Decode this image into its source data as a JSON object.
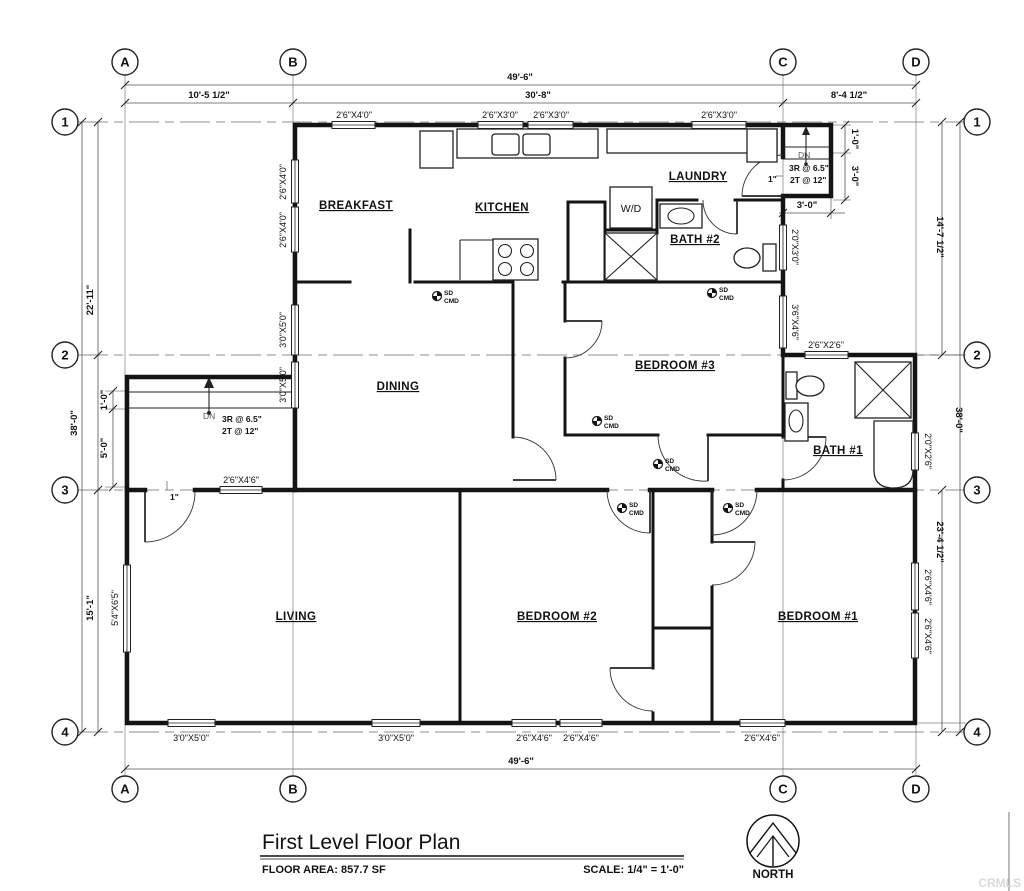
{
  "grid": {
    "cols": [
      "A",
      "B",
      "C",
      "D"
    ],
    "rows": [
      "1",
      "2",
      "3",
      "4"
    ]
  },
  "dims": {
    "overall_w": "49'-6\"",
    "ab": "10'-5 1/2\"",
    "bc": "30'-8\"",
    "cd": "8'-4 1/2\"",
    "left_12": "22'-11\"",
    "overall_h": "38'-0\"",
    "left_34": "15'-1\"",
    "right_12": "14'-7 1/2\"",
    "right_34": "23'-4 1/2\"",
    "one_ft": "1'-0\"",
    "five_ft": "5'-0\"",
    "three_ft": "3'-0\"",
    "one_in": "1\""
  },
  "rooms": {
    "breakfast": "BREAKFAST",
    "kitchen": "KITCHEN",
    "laundry": "LAUNDRY",
    "bath2": "BATH #2",
    "dining": "DINING",
    "bedroom3": "BEDROOM #3",
    "bath1": "BATH #1",
    "living": "LIVING",
    "bedroom2": "BEDROOM #2",
    "bedroom1": "BEDROOM #1",
    "wd": "W/D"
  },
  "windows": {
    "s2640": "2'6\"X4'0\"",
    "s2630": "2'6\"X3'0\"",
    "s3050": "3'0\"X5'0\"",
    "s2646": "2'6\"X4'6\"",
    "s2030": "2'0\"X3'0\"",
    "s3646": "3'6\"X4'6\"",
    "s2626": "2'6\"X2'6\"",
    "s2026": "2'0\"X2'6\"",
    "s5465": "5'4\"X6'5\""
  },
  "stairs": {
    "down_label": "DN",
    "riser_note": "3R @ 6.5\"",
    "tread_note": "2T @ 12\""
  },
  "detector": {
    "sd": "SD",
    "cmd": "CMD"
  },
  "title_block": {
    "title": "First Level Floor Plan",
    "floor_area": "FLOOR AREA: 857.7 SF",
    "scale": "SCALE: 1/4\" = 1'-0\"",
    "north": "NORTH"
  },
  "watermark": "CRMLS"
}
